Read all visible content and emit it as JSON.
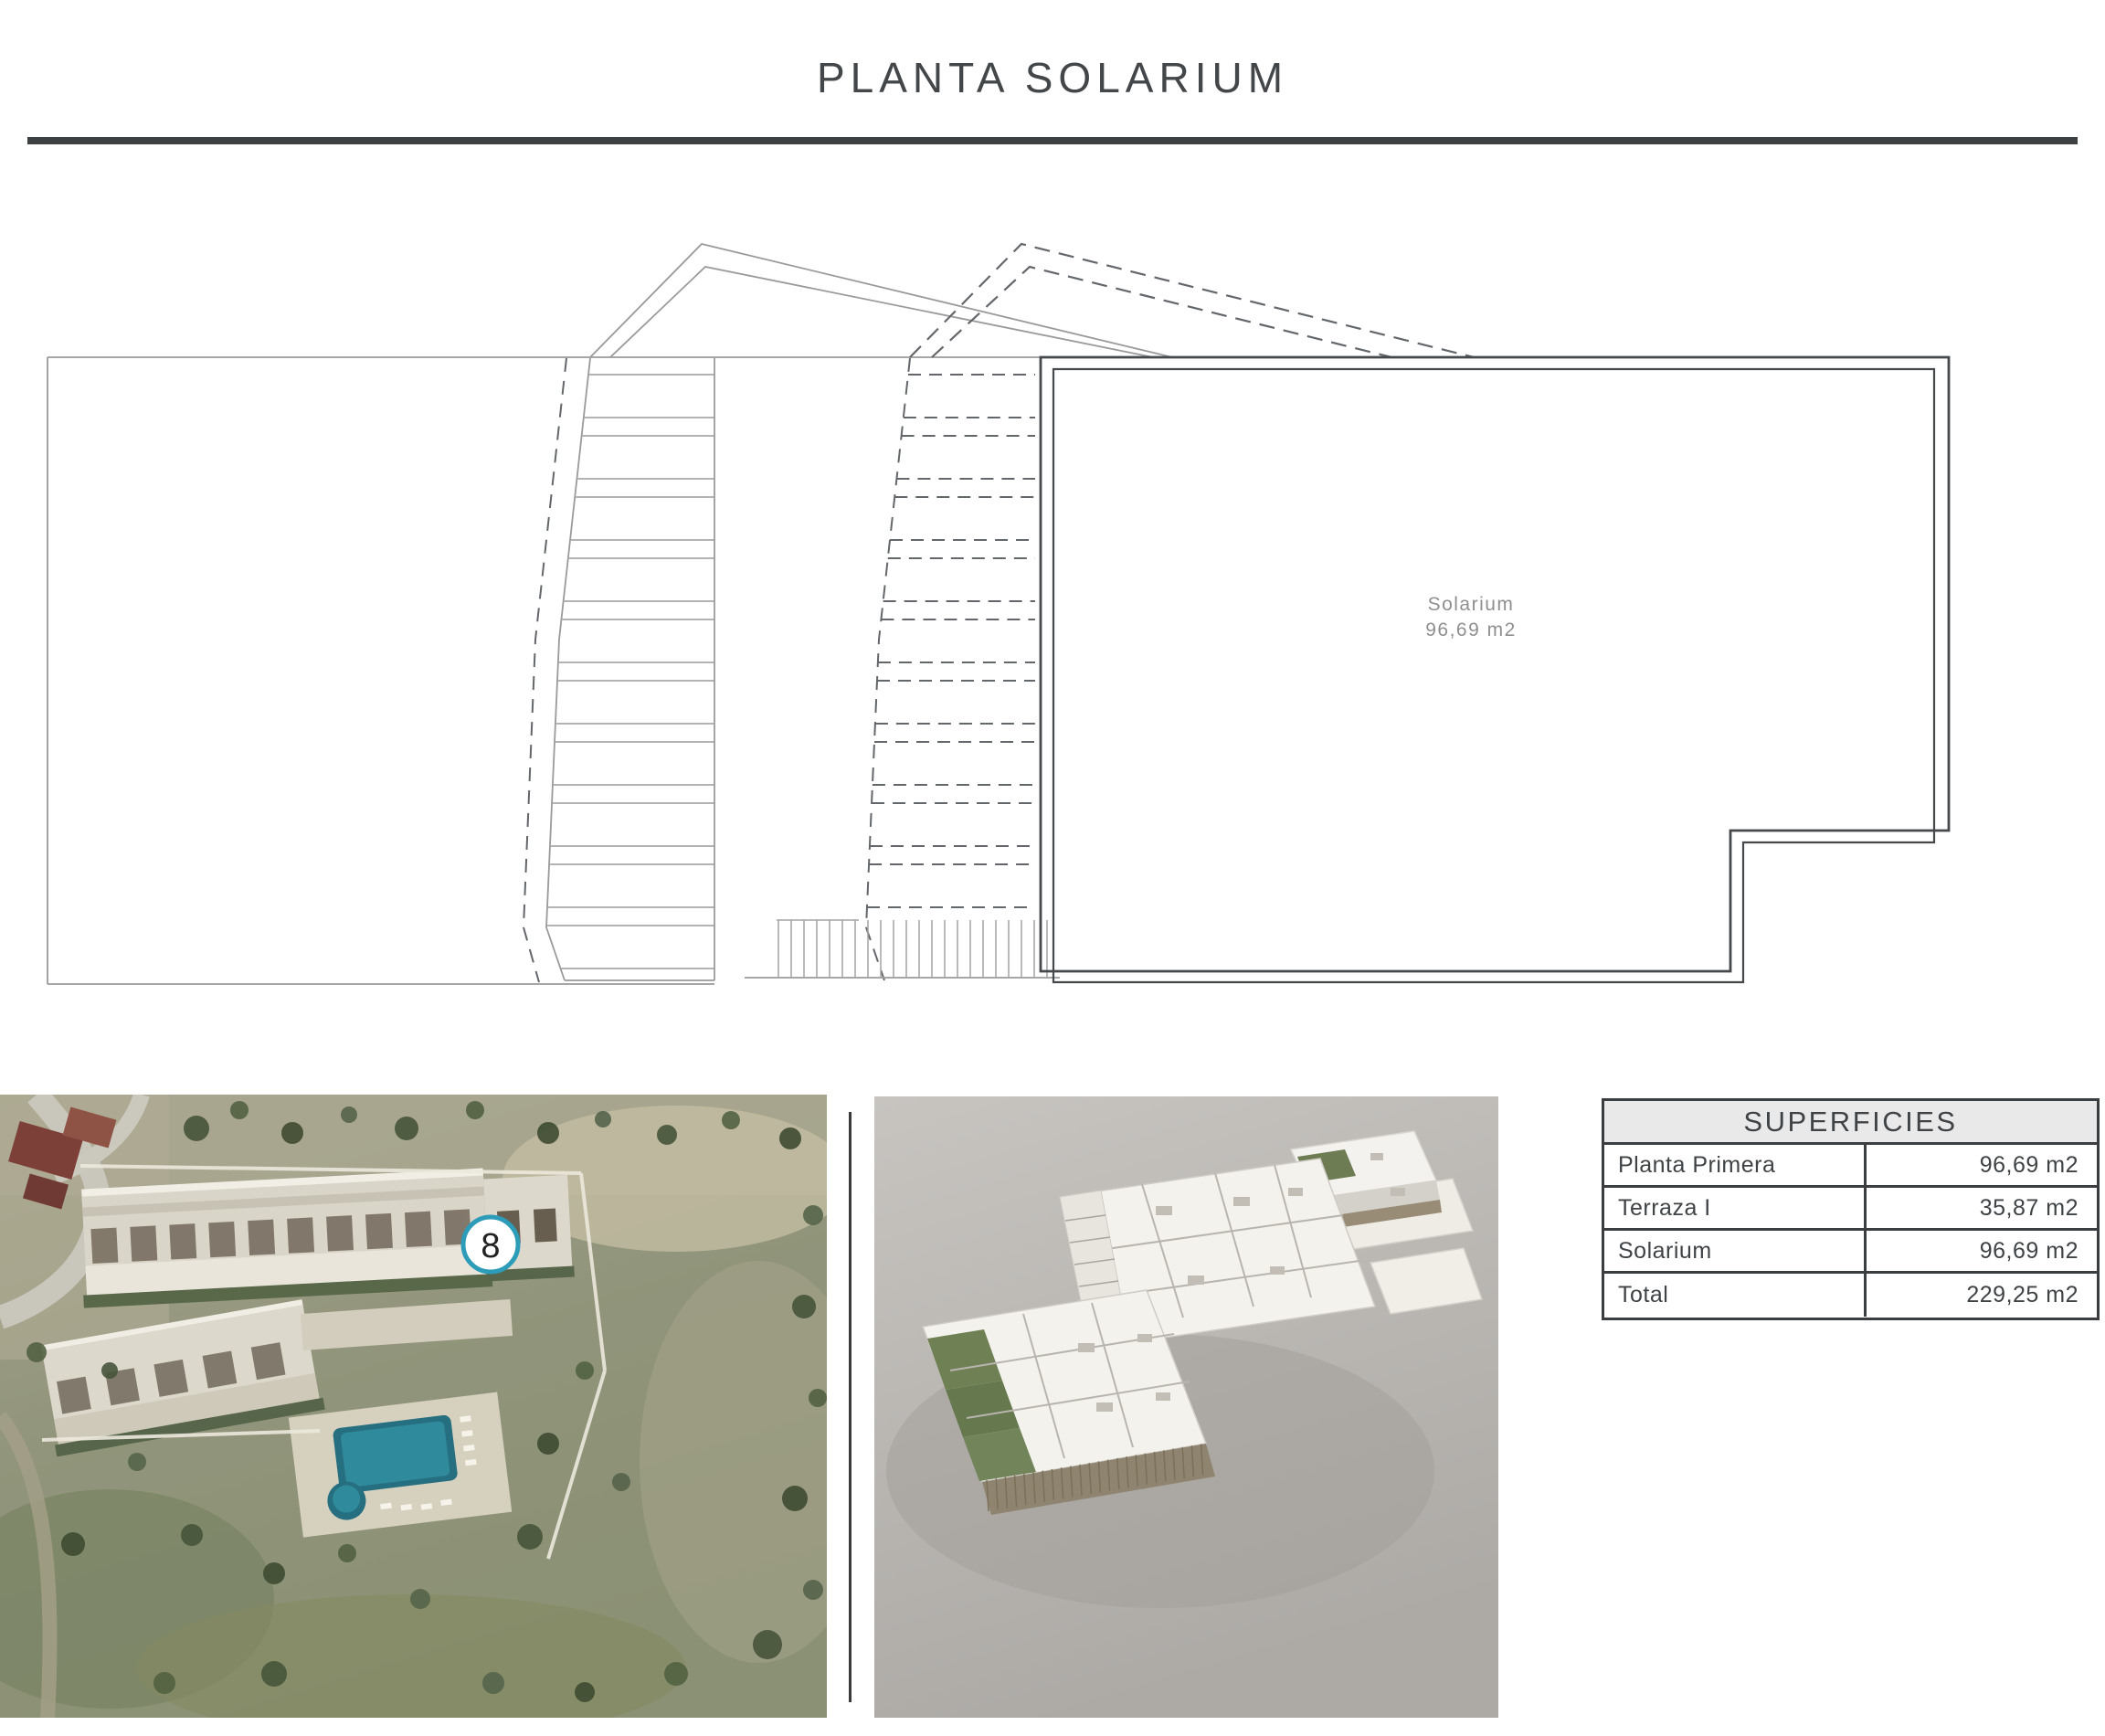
{
  "page": {
    "title": "PLANTA SOLARIUM",
    "accent_teal": "#2c9cb8",
    "table_header_bg": "#e9e9e9",
    "rule_color": "#3c4043"
  },
  "plan": {
    "room_label": "Solarium",
    "room_area": "96,69 m2"
  },
  "aerial_photo": {
    "unit_marker": "8"
  },
  "surfaces_table": {
    "header": "SUPERFICIES",
    "rows": [
      {
        "label": "Planta Primera",
        "value": "96,69 m2"
      },
      {
        "label": "Terraza I",
        "value": "35,87 m2"
      },
      {
        "label": "Solarium",
        "value": "96,69 m2"
      },
      {
        "label": "Total",
        "value": "229,25 m2"
      }
    ]
  }
}
